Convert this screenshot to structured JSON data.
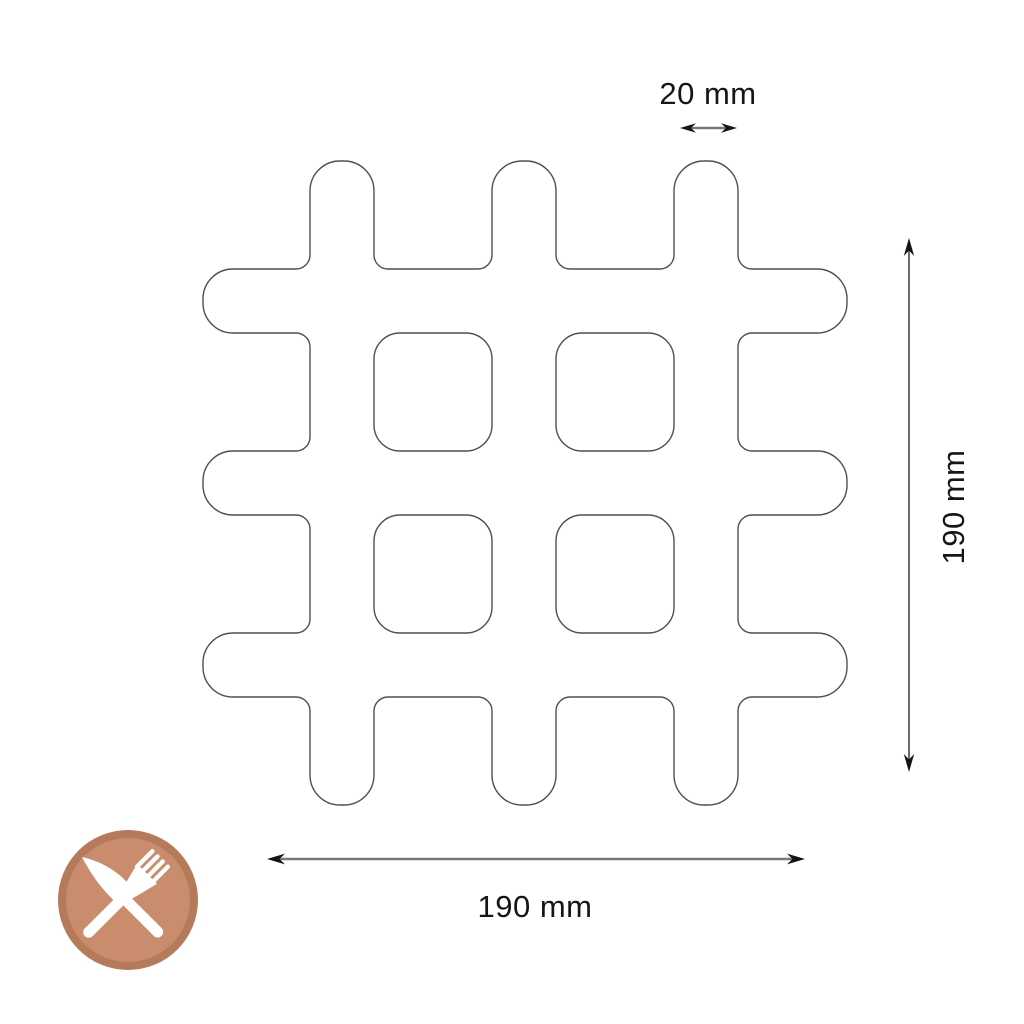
{
  "diagram": {
    "type": "product-dimension-drawing",
    "outline_color": "#4f4f4f",
    "dimension_line_color": "#787878",
    "height_line_color": "#5a5a5a",
    "arrowhead_color": "#141414",
    "text_color": "#161616",
    "labels": {
      "bar_width": "20 mm",
      "overall_height": "190 mm",
      "overall_width": "190 mm"
    },
    "measurements": {
      "bar_width_mm": 20,
      "overall_width_mm": 190,
      "overall_height_mm": 190
    }
  },
  "badge": {
    "icon": "fork-and-knife-crossed",
    "ring_color": "#b57a5a",
    "fill_color": "#c98d6e",
    "glyph_color": "#ffffff"
  }
}
